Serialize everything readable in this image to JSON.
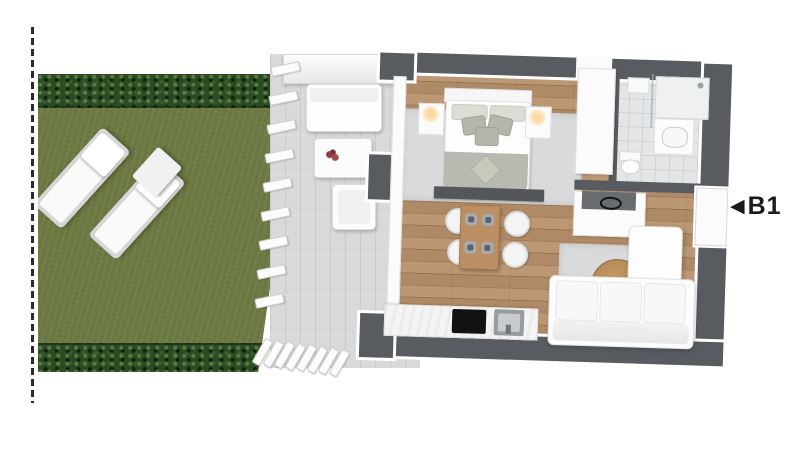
{
  "marker": {
    "arrow_glyph": "◀",
    "unit_label": "B1"
  },
  "icons": {
    "unit_marker": "left-arrow-triangle-icon"
  },
  "colors": {
    "lawn": "#6d7942",
    "hedge": "#2e4a25",
    "wall_dark": "#585c60",
    "wood_floor": "#b8916b",
    "terrace_deck": "#d8d9db",
    "bathroom_tile": "#e3e5e7",
    "rug": "#d9dadb",
    "table_wood": "#b98f63",
    "label_text": "#1a1a1a"
  }
}
